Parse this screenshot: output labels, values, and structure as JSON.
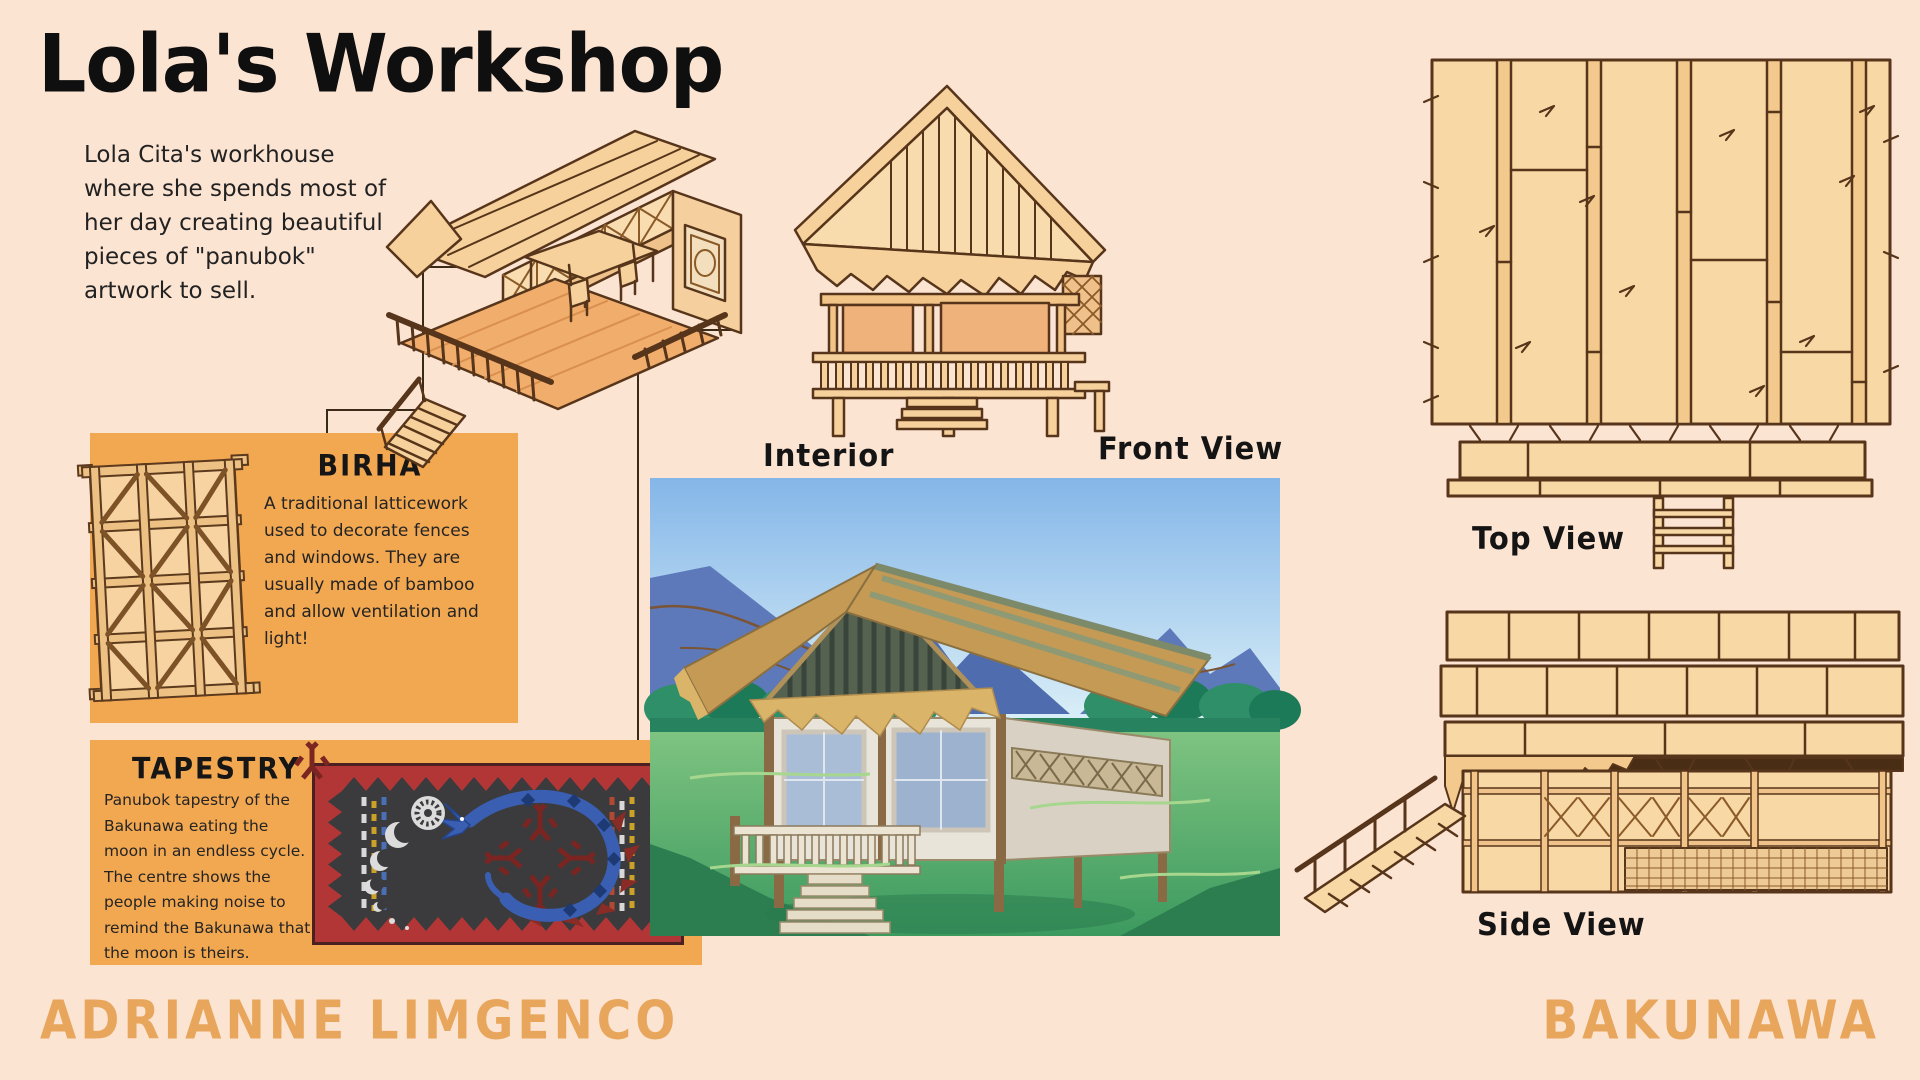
{
  "page": {
    "title": "Lola's Workshop",
    "intro": "Lola Cita's workhouse where she spends most of her day creating beautiful pieces of \"panubok\" artwork to sell.",
    "author": "ADRIANNE LIMGENCO",
    "project": "BAKUNAWA"
  },
  "callouts": {
    "birha": {
      "title": "BIRHA",
      "body": "A traditional latticework used to decorate fences and windows. They are usually made of bamboo and allow ventilation and light!"
    },
    "tapestry": {
      "title": "TAPESTRY",
      "body": "Panubok tapestry of the Bakunawa eating the moon in an endless cycle. The centre shows the people making noise to remind the Bakunawa that the moon is theirs."
    }
  },
  "views": {
    "interior_label": "Interior",
    "front_label": "Front View",
    "top_label": "Top View",
    "side_label": "Side View"
  },
  "colors": {
    "background": "#fce4d3",
    "panel_orange": "#f2a751",
    "line_art_fill": "#f8d8a5",
    "line_art_stroke": "#57351a",
    "accent_text": "#e8a65c",
    "ink": "#141414",
    "tapestry_red": "#b23636",
    "tapestry_dark": "#3b3b3d",
    "bakunawa_blue": "#3a5fb2"
  }
}
